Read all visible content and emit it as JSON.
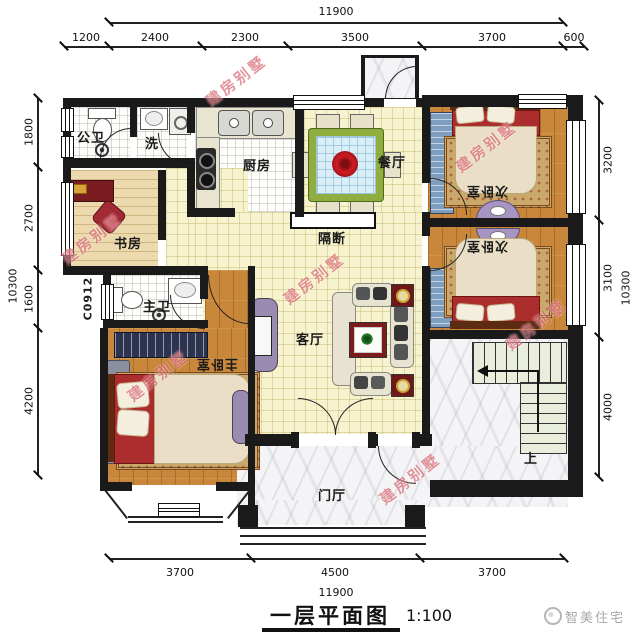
{
  "meta": {
    "title_text": "一层平面图",
    "scale_text": "1:100",
    "brand": "智美住宅",
    "watermark": "建房别墅"
  },
  "rooms": {
    "public_bath": "公卫",
    "laundry": "洗",
    "kitchen": "厨房",
    "dining": "餐厅",
    "bedroom_a": "次卧室",
    "bedroom_b": "次卧室",
    "study": "书房",
    "partition": "隔断",
    "master_bath": "主卫",
    "living": "客厅",
    "master_bedroom": "主卧室",
    "foyer": "门厅",
    "stairs_up": "上",
    "window_code": "C0912"
  },
  "dimensions": {
    "top": {
      "total": "11900",
      "segments": [
        "1200",
        "2400",
        "2300",
        "3500",
        "3700",
        "600"
      ]
    },
    "bottom": {
      "total": "11900",
      "segments": [
        "3700",
        "4500",
        "3700"
      ]
    },
    "left": {
      "total": "10300",
      "segments": [
        "1800",
        "2700",
        "1600",
        "4200"
      ]
    },
    "right": {
      "total": "10300",
      "segments": [
        "3200",
        "3100",
        "4000"
      ]
    }
  },
  "colors": {
    "wall": "#1a1a1a",
    "tile_floor": "#f8f3cf",
    "wood_floor": "#c8873b",
    "study_floor": "#ecd9ad",
    "marble": "#f4f4f6",
    "stair": "#e8eedb",
    "bed_red": "#ab2d2d",
    "table_green": "#8fae3f",
    "watermark_red": "rgba(200,40,55,0.5)"
  }
}
